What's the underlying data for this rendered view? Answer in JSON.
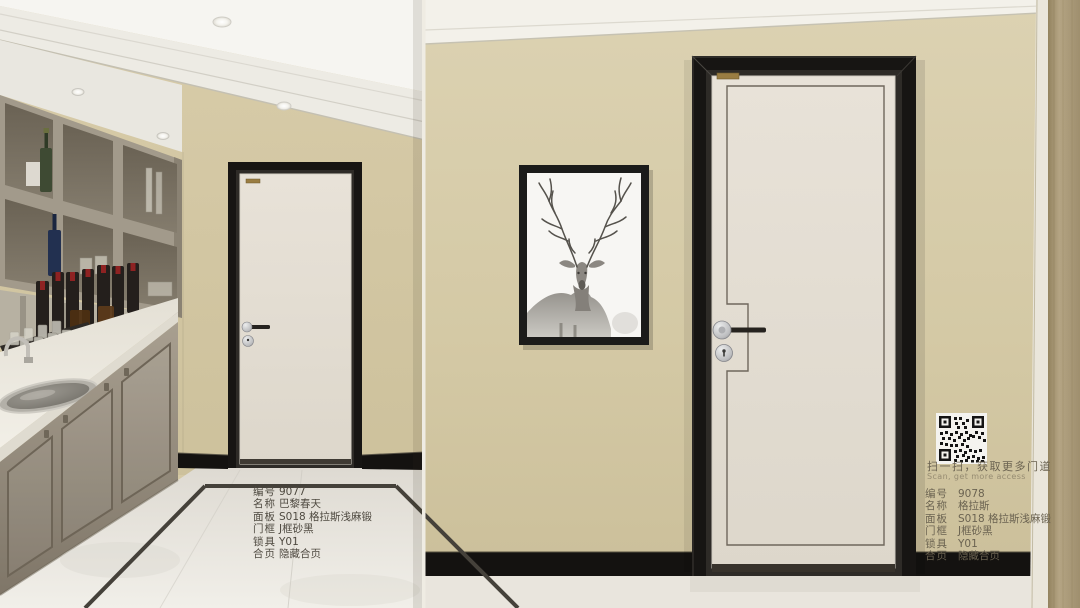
{
  "left_product": {
    "specs": [
      {
        "label": "编号",
        "value": "9077"
      },
      {
        "label": "名称",
        "value": "巴黎春天"
      },
      {
        "label": "面板",
        "value": "S018 格拉斯浅麻锻"
      },
      {
        "label": "门框",
        "value": "J框砂黑"
      },
      {
        "label": "锁具",
        "value": "Y01"
      },
      {
        "label": "合页",
        "value": "隐藏合页"
      }
    ]
  },
  "right_product": {
    "scan_prompt_cn": "扫一扫，获取更多门道",
    "scan_prompt_en": "Scan, get more access",
    "specs": [
      {
        "label": "编号",
        "value": "9078"
      },
      {
        "label": "名称",
        "value": "格拉斯"
      },
      {
        "label": "面板",
        "value": "S018 格拉斯浅麻锻"
      },
      {
        "label": "门框",
        "value": "J框砂黑"
      },
      {
        "label": "锁具",
        "value": "Y01"
      },
      {
        "label": "合页",
        "value": "隐藏合页"
      }
    ]
  },
  "colors": {
    "wall_beige": "#d5c9a5",
    "wall_side_tan": "#ab9b79",
    "door_panel": "#e5dfd5",
    "door_frame": "#171513",
    "molding_white": "#f3f1ea",
    "baseboard_black": "#141210",
    "floor_light": "#e9e5dd",
    "text_dark": "#4f4a41",
    "brand_plate_gold": "#9a7d42",
    "handle_metal": "#c9cacc",
    "handle_bar": "#26231f"
  }
}
